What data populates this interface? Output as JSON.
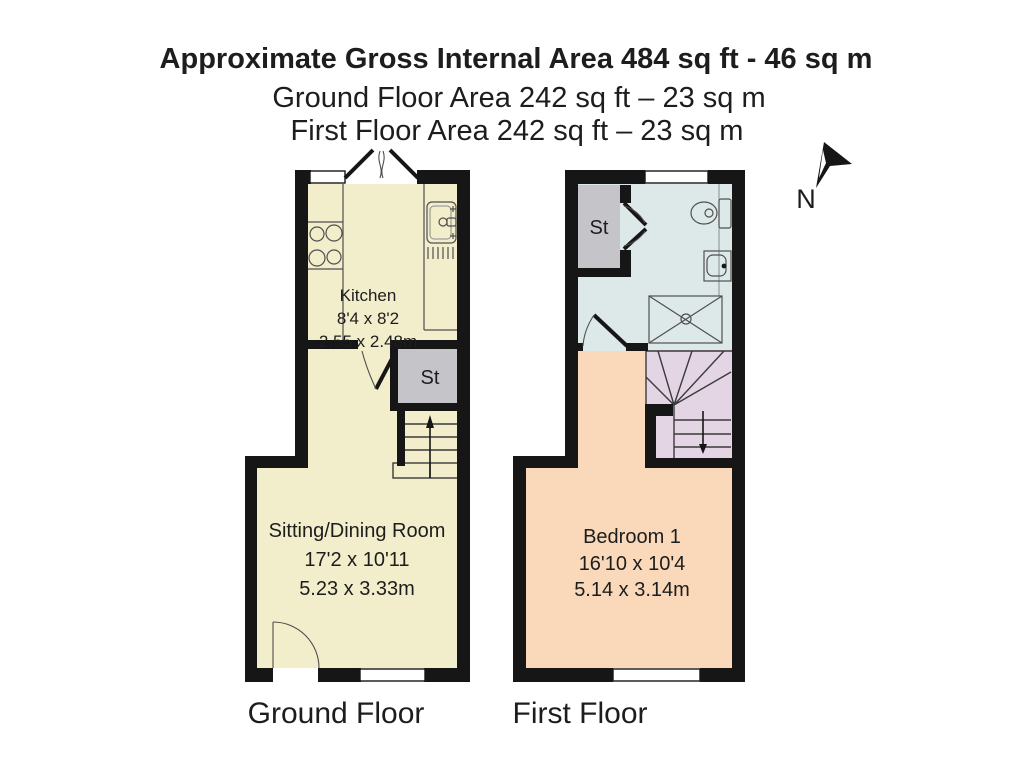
{
  "header": {
    "title": "Approximate Gross Internal Area 484 sq ft - 46 sq m",
    "ground_floor_area": "Ground Floor Area 242 sq ft – 23 sq m",
    "first_floor_area": "First Floor Area 242 sq ft – 23 sq m"
  },
  "compass": {
    "north_label": "N"
  },
  "ground_floor": {
    "label": "Ground Floor",
    "kitchen": {
      "name": "Kitchen",
      "dims_imperial": "8'4 x 8'2",
      "dims_metric": "2.55 x 2.48m"
    },
    "sitting_dining_room": {
      "name": "Sitting/Dining Room",
      "dims_imperial": "17'2 x 10'11",
      "dims_metric": "5.23 x 3.33m"
    },
    "storage": {
      "label": "St"
    }
  },
  "first_floor": {
    "label": "First Floor",
    "bedroom_1": {
      "name": "Bedroom 1",
      "dims_imperial": "16'10 x 10'4",
      "dims_metric": "5.14 x 3.14m"
    },
    "storage": {
      "label": "St"
    }
  },
  "colors": {
    "wall": "#161616",
    "ground_floor_room": "#f2eecb",
    "bedroom": "#f9d9ba",
    "bathroom": "#dde9e9",
    "stairs": "#e4d5e5",
    "storage": "#c5c4c9",
    "background": "#ffffff"
  }
}
